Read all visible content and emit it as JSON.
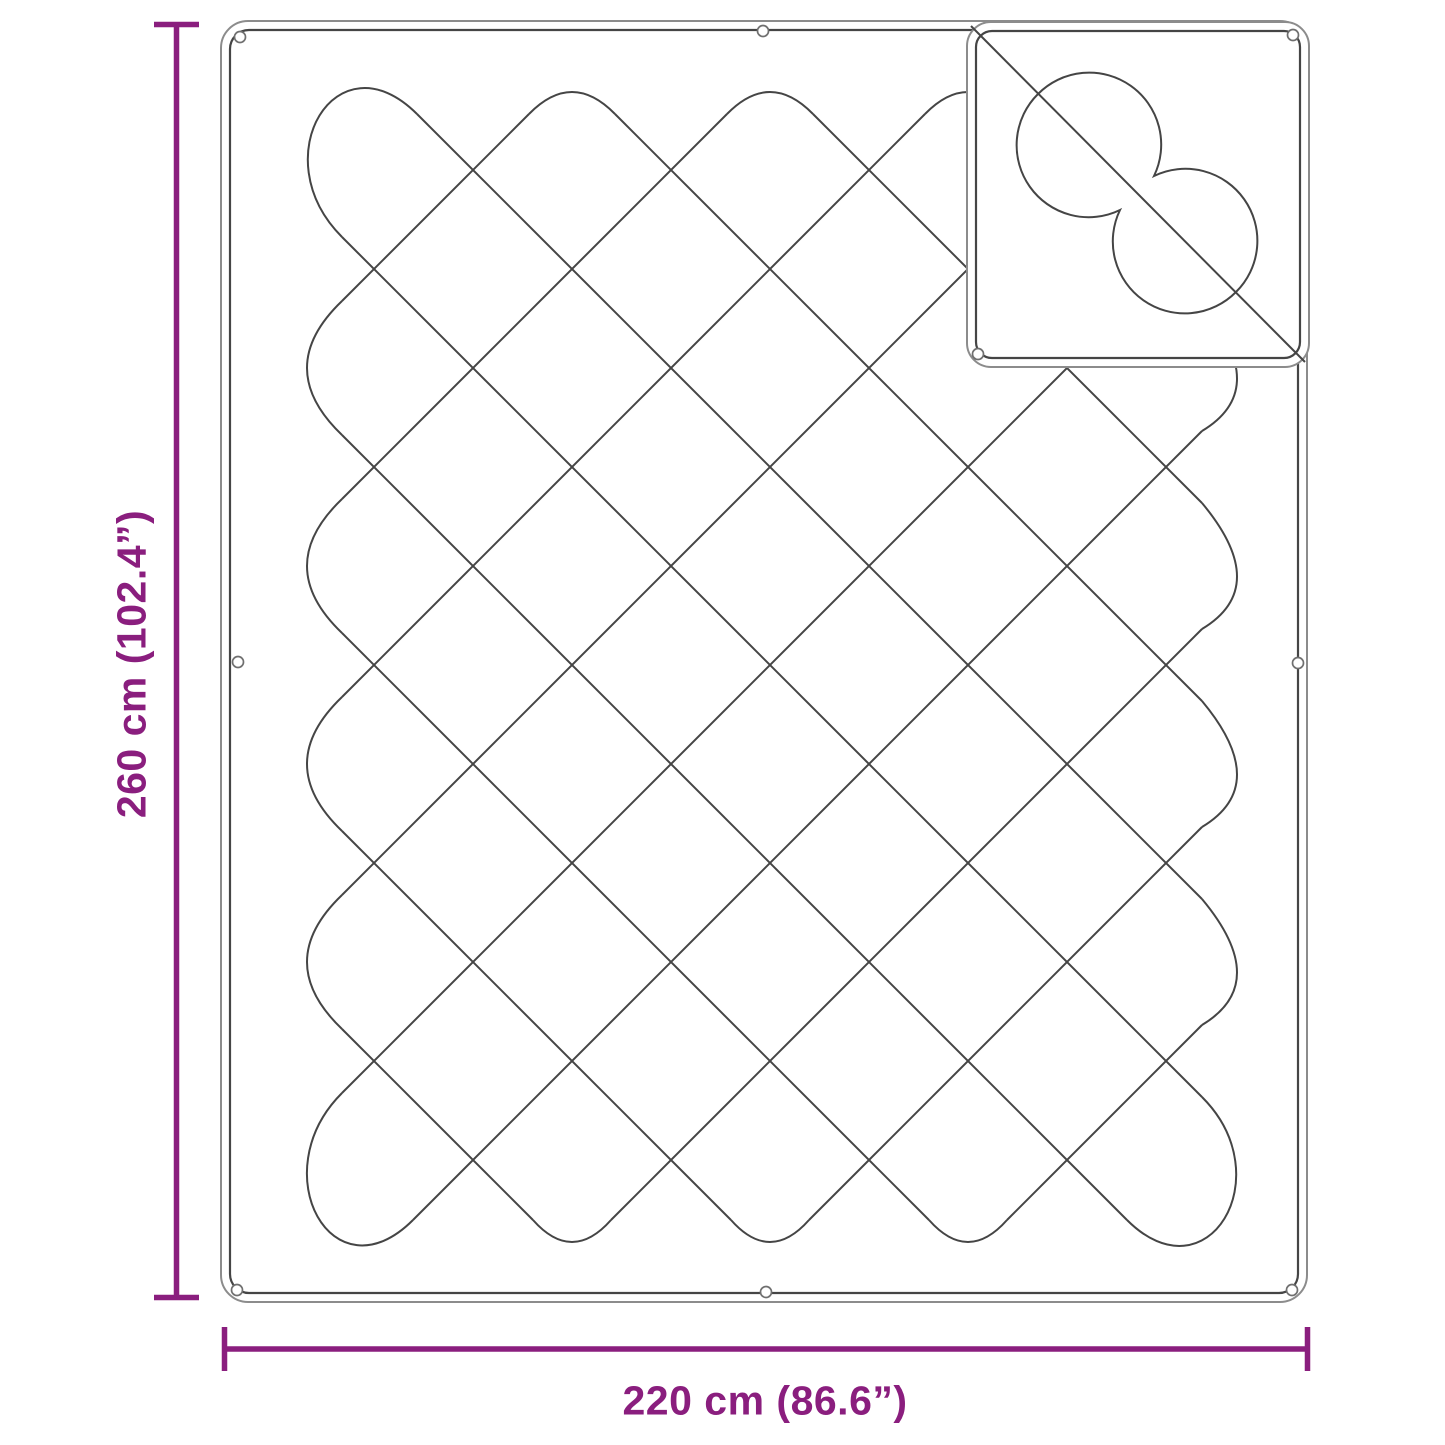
{
  "figure": {
    "type": "product-dimension-diagram",
    "subject": "quilted blanket with folded corner showing reverse-side stitching",
    "background_color": "#ffffff",
    "accent_color": "#8A1E7E",
    "stitch_line_color": "#454545",
    "edge_line_color": "#8c8c8c",
    "dimensions": {
      "height_label": "260 cm (102.4”)",
      "width_label": "220 cm (86.6”)"
    }
  }
}
